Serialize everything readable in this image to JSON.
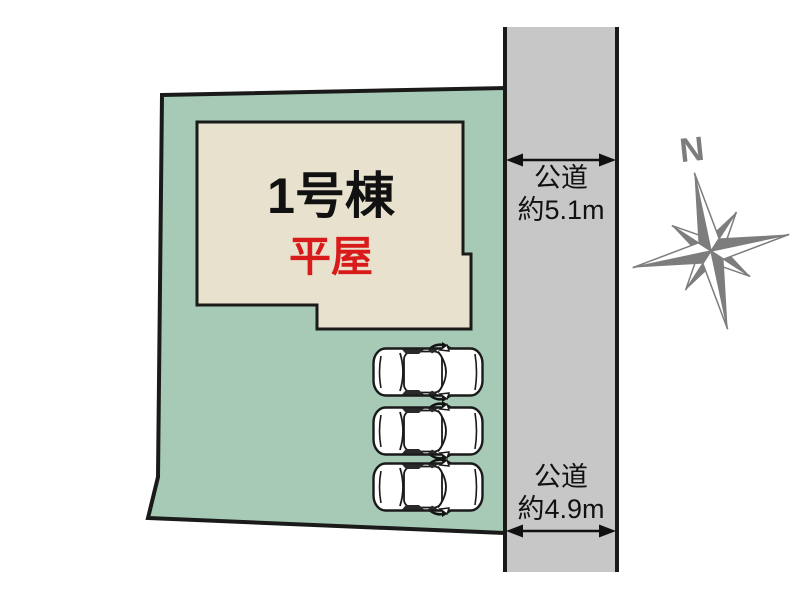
{
  "canvas": {
    "width": 800,
    "height": 602,
    "background": "#ffffff"
  },
  "plot": {
    "fill": "#a6cab5",
    "stroke": "#1a1a1a"
  },
  "building": {
    "fill": "#e8e1cd",
    "stroke": "#1a1a1a",
    "name": "1号棟",
    "name_color": "#111111",
    "storey": "平屋",
    "storey_color": "#d91a1a"
  },
  "road": {
    "fill": "#c7c7c7",
    "border": "#1a1a1a",
    "top_label": {
      "line1": "公道",
      "line2": "約5.1m"
    },
    "bottom_label": {
      "line1": "公道",
      "line2": "約4.9m"
    }
  },
  "compass": {
    "label": "N",
    "color": "#7d7d7d"
  },
  "parking": {
    "car_count": 3,
    "car_fill": "#ffffff",
    "car_stroke": "#1a1a1a",
    "positions": [
      {
        "x": 372,
        "y": 347
      },
      {
        "x": 372,
        "y": 406
      },
      {
        "x": 372,
        "y": 462
      }
    ]
  }
}
